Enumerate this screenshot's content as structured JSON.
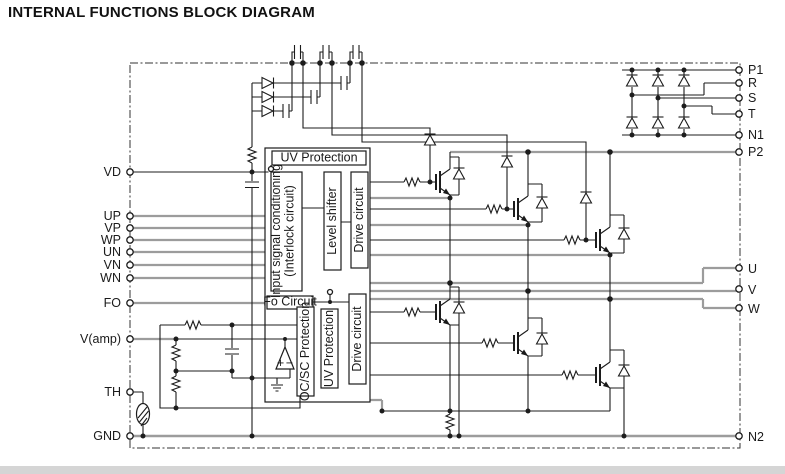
{
  "title": "INTERNAL FUNCTIONS BLOCK DIAGRAM",
  "pins": {
    "left": [
      {
        "label": "VD"
      },
      {
        "label": "UP"
      },
      {
        "label": "VP"
      },
      {
        "label": "WP"
      },
      {
        "label": "UN"
      },
      {
        "label": "VN"
      },
      {
        "label": "WN"
      },
      {
        "label": "FO"
      },
      {
        "label": "V(amp)"
      },
      {
        "label": "TH"
      },
      {
        "label": "GND"
      }
    ],
    "right": [
      {
        "label": "P1"
      },
      {
        "label": "R"
      },
      {
        "label": "S"
      },
      {
        "label": "T"
      },
      {
        "label": "N1"
      },
      {
        "label": "P2"
      },
      {
        "label": "U"
      },
      {
        "label": "V"
      },
      {
        "label": "W"
      },
      {
        "label": "N2"
      }
    ]
  },
  "blocks": {
    "uv_top": "UV Protection",
    "input_l1": "Input signal conditioning",
    "input_l2": "(Interlock circuit)",
    "level_shifter": "Level shifter",
    "drive_upper": "Drive circuit",
    "fo_circuit": "Fo Circuit",
    "ocsc": "OC/SC Protection",
    "uv_lower": "UV Protection",
    "drive_lower": "Drive circuit"
  },
  "comparator": {
    "plus": "+",
    "minus": "−"
  },
  "colors": {
    "wire_gray": "#9c9c9c",
    "wire_black": "#1c1c1c",
    "box_border": "#1c1c1c",
    "footer_strip": "#d5d5d5"
  }
}
